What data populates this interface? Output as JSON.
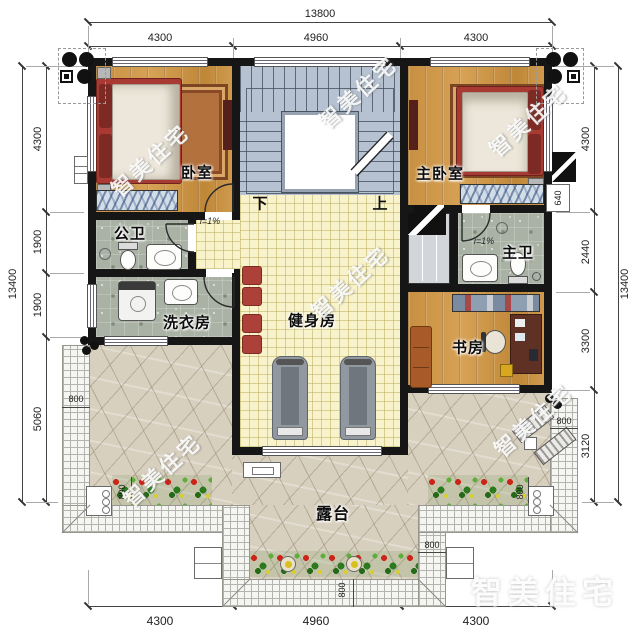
{
  "plan": {
    "watermark": "智美住宅",
    "rooms": {
      "bedroom": "卧室",
      "master_bedroom": "主卧室",
      "public_bath": "公卫",
      "master_bath": "主卫",
      "laundry": "洗衣房",
      "gym": "健身房",
      "study": "书房",
      "terrace": "露台"
    },
    "stairs": {
      "down": "下",
      "up": "上"
    },
    "slope": "i=1%",
    "dims": {
      "top_overall": "13800",
      "top_segments": [
        "4300",
        "4960",
        "4300"
      ],
      "left_overall": "13400",
      "left_segments": [
        "4300",
        "1900",
        "1900",
        "5060"
      ],
      "right_overall": "13400",
      "right_segments": [
        "4300",
        "2440",
        "3300",
        "3120"
      ],
      "bottom_segments": [
        "4300",
        "4960",
        "4300"
      ],
      "walkway": "800",
      "flue": "640"
    }
  }
}
